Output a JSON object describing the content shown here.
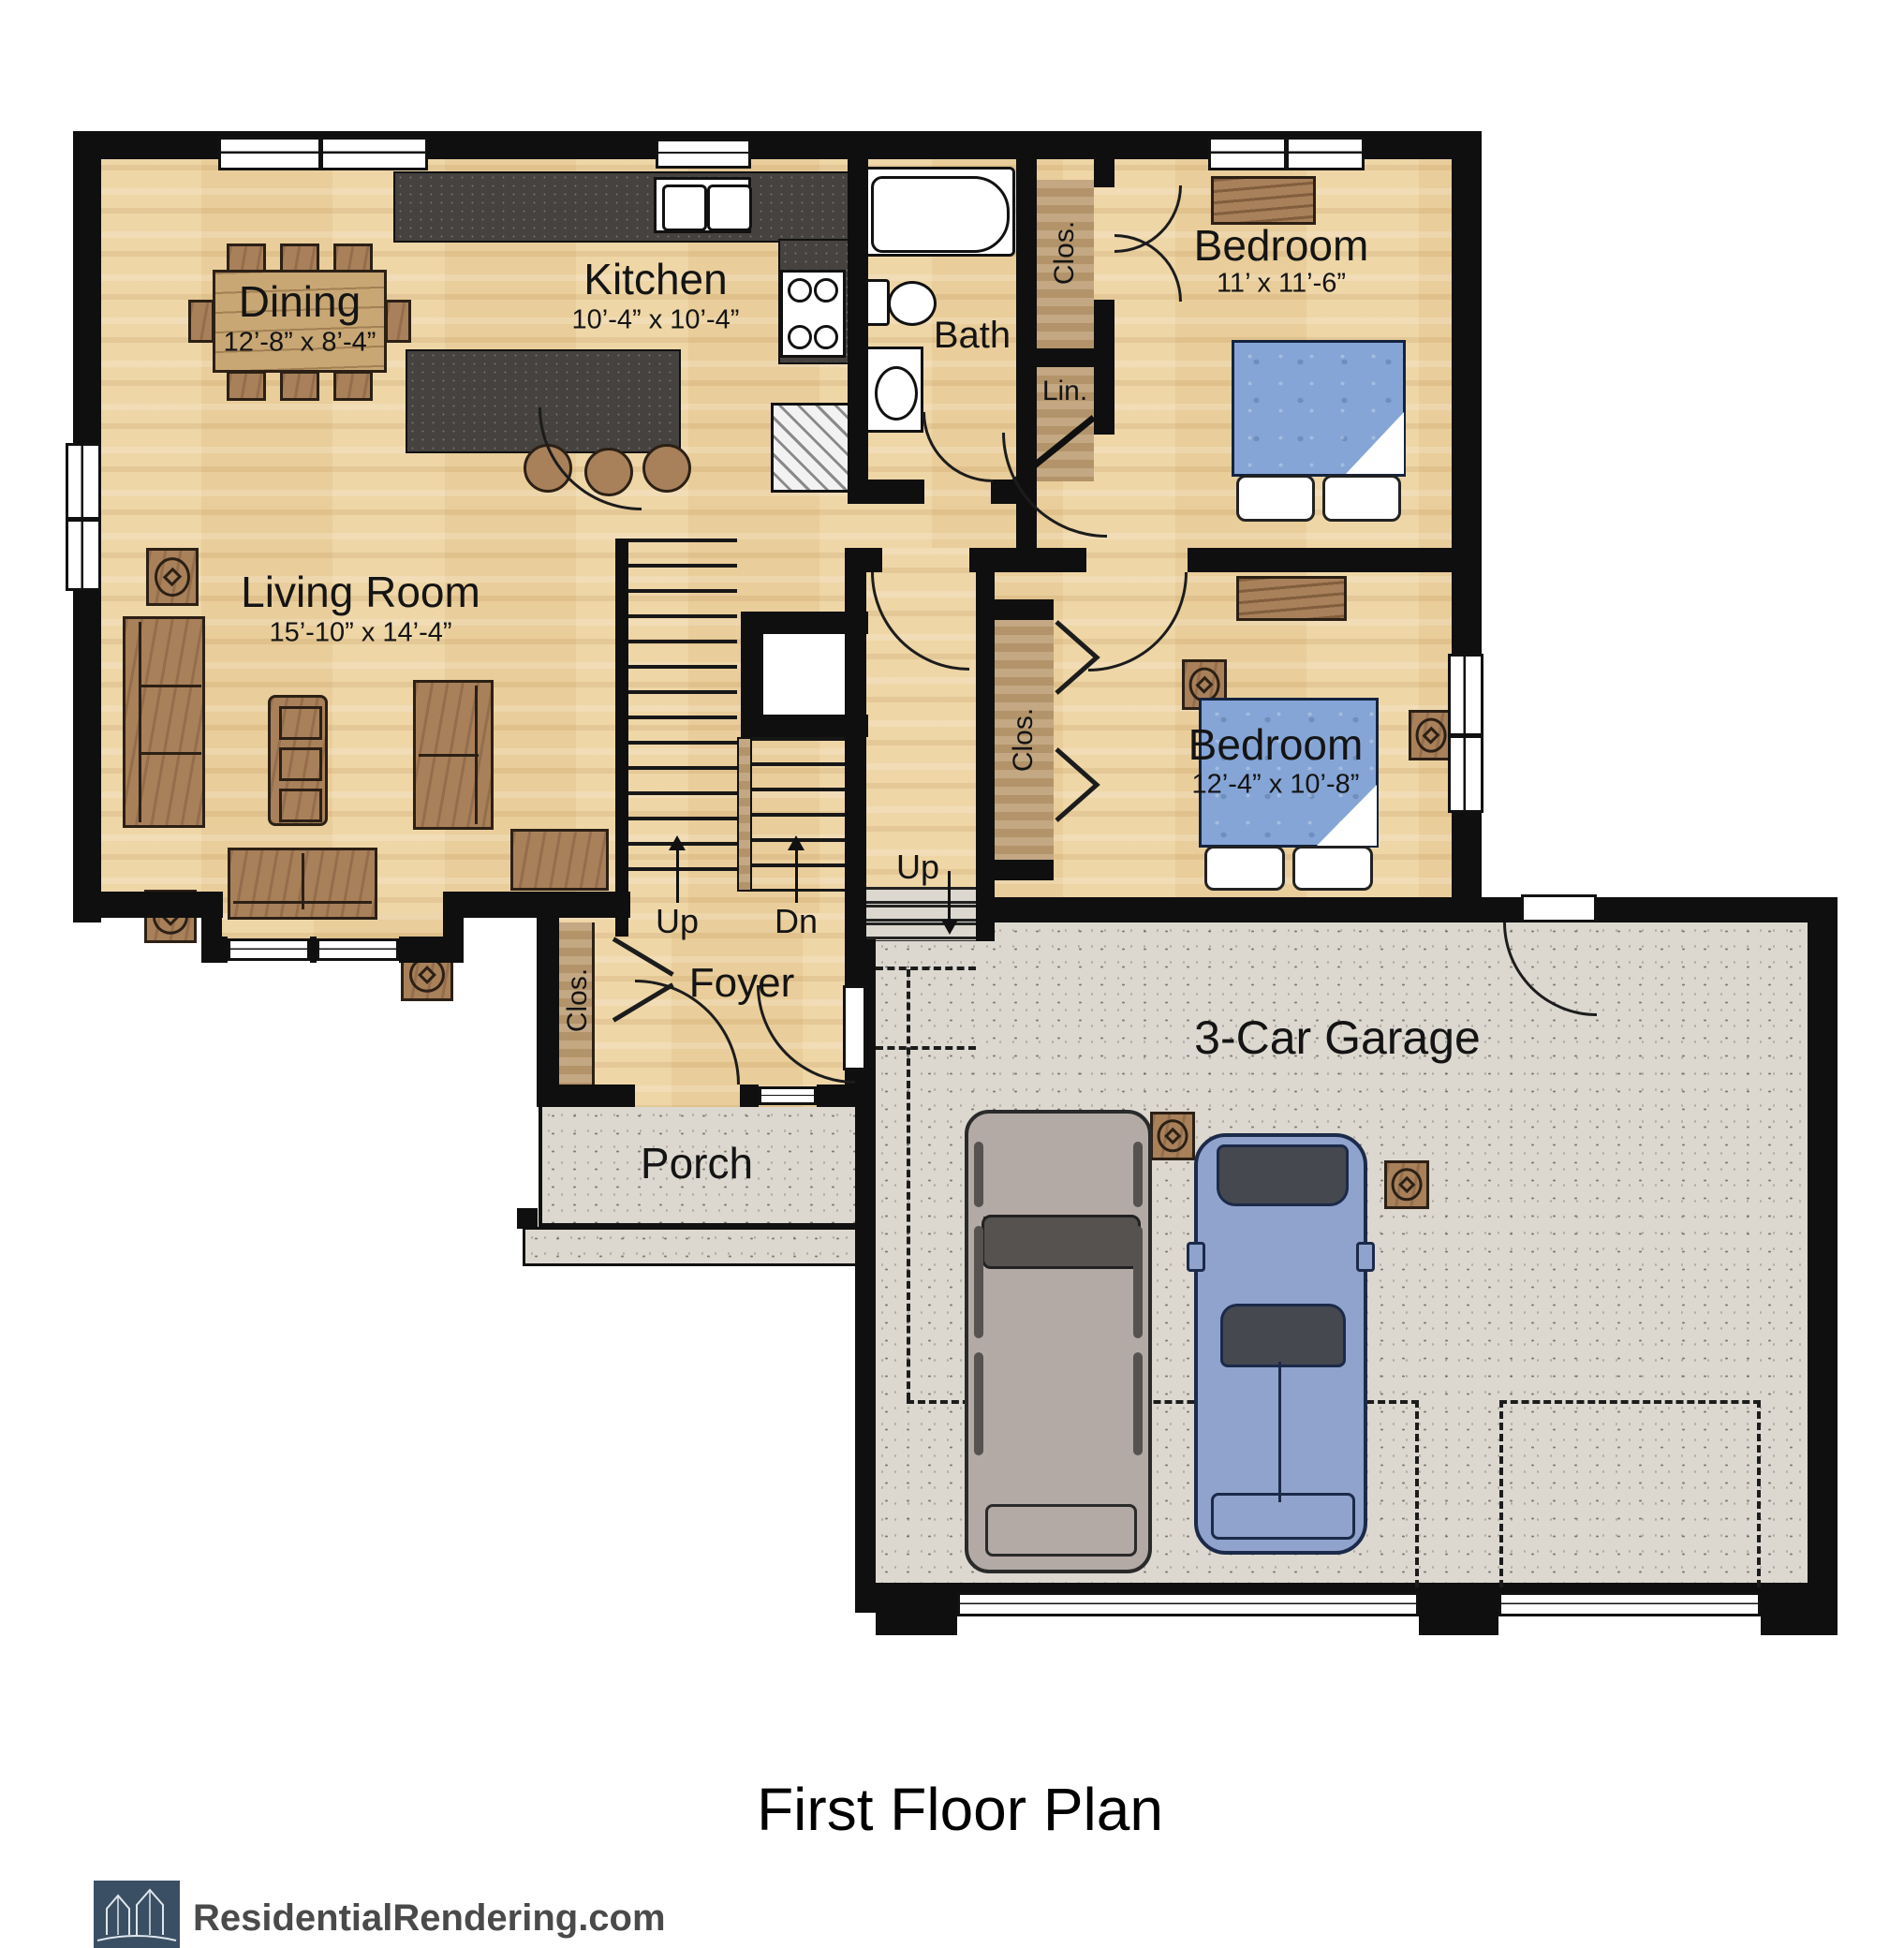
{
  "title": "First Floor Plan",
  "watermark": "ResidentialRendering.com",
  "rooms": {
    "dining": {
      "name": "Dining",
      "dims": "12’-8” x 8’-4”"
    },
    "kitchen": {
      "name": "Kitchen",
      "dims": "10’-4” x 10’-4”"
    },
    "bath": {
      "name": "Bath"
    },
    "bedroom1": {
      "name": "Bedroom",
      "dims": "11’ x 11’-6”"
    },
    "living": {
      "name": "Living Room",
      "dims": "15’-10” x 14’-4”"
    },
    "bedroom2": {
      "name": "Bedroom",
      "dims": "12’-4” x 10’-8”"
    },
    "foyer": {
      "name": "Foyer"
    },
    "porch": {
      "name": "Porch"
    },
    "garage": {
      "name": "3-Car Garage"
    }
  },
  "closets": {
    "linen": "Lin.",
    "closet": "Clos."
  },
  "stairs": {
    "up": "Up",
    "down": "Dn",
    "garage_entry": "Up"
  },
  "colors": {
    "wood": "#ecd2a0",
    "concrete": "#dcd8d0",
    "wall": "#0f0f0f",
    "bed_blue": "#85a5d6",
    "counter": "#45423f",
    "furniture": "#a8805a",
    "logo": "#3a4f63",
    "truck": "#b3aaa6",
    "car": "#8fa3cc"
  }
}
